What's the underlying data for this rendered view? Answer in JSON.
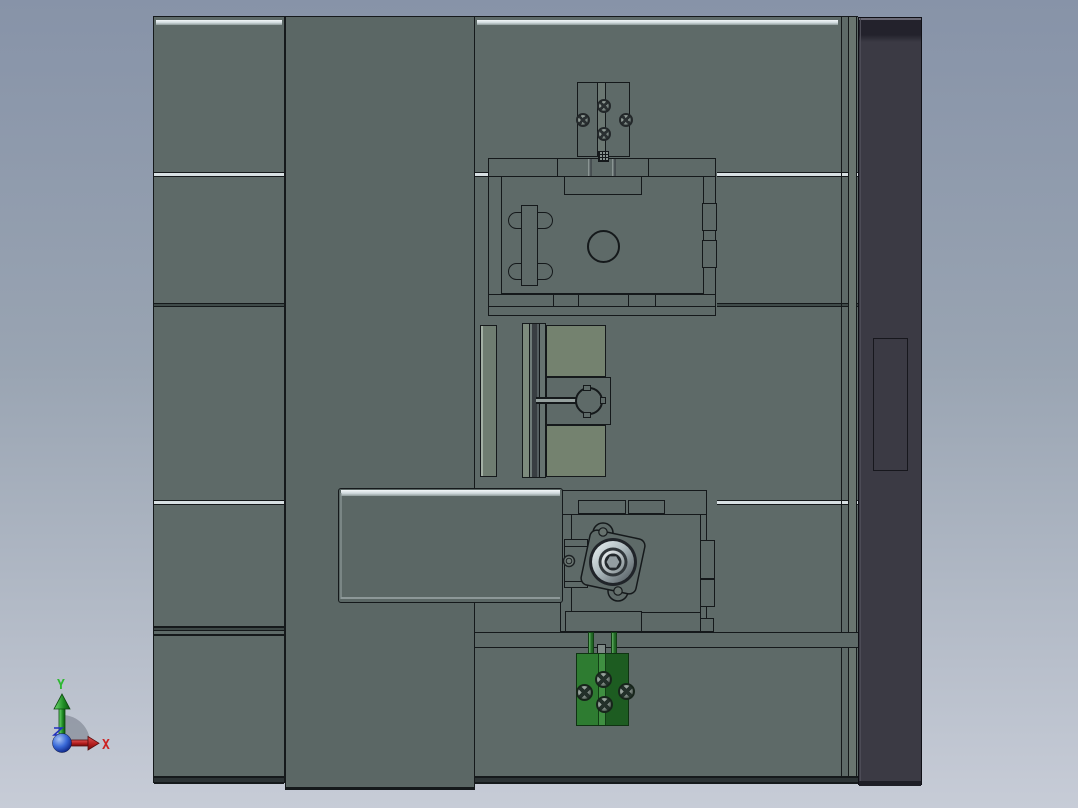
{
  "viewport": {
    "description": "CAD assembly viewport, top orthographic view of a machining fixture",
    "triad": {
      "x_label": "X",
      "y_label": "Y",
      "z_label": "Z"
    }
  },
  "colors": {
    "background_top": "#8793a8",
    "background_mid": "#99a4b2",
    "background_bottom": "#c7ccd7",
    "body_gray": "#5e6a68",
    "center_column_gray": "#5b6765",
    "panel_green_gray": "#74826f",
    "side_panel_dark": "#3b3a44",
    "outline_dark": "#15191b",
    "green_bright": "#2e7c31",
    "green_dark": "#1d5c21",
    "axis_x_red": "#cc2222",
    "axis_y_green": "#2eb832",
    "origin_blue": "#2a52c8"
  }
}
